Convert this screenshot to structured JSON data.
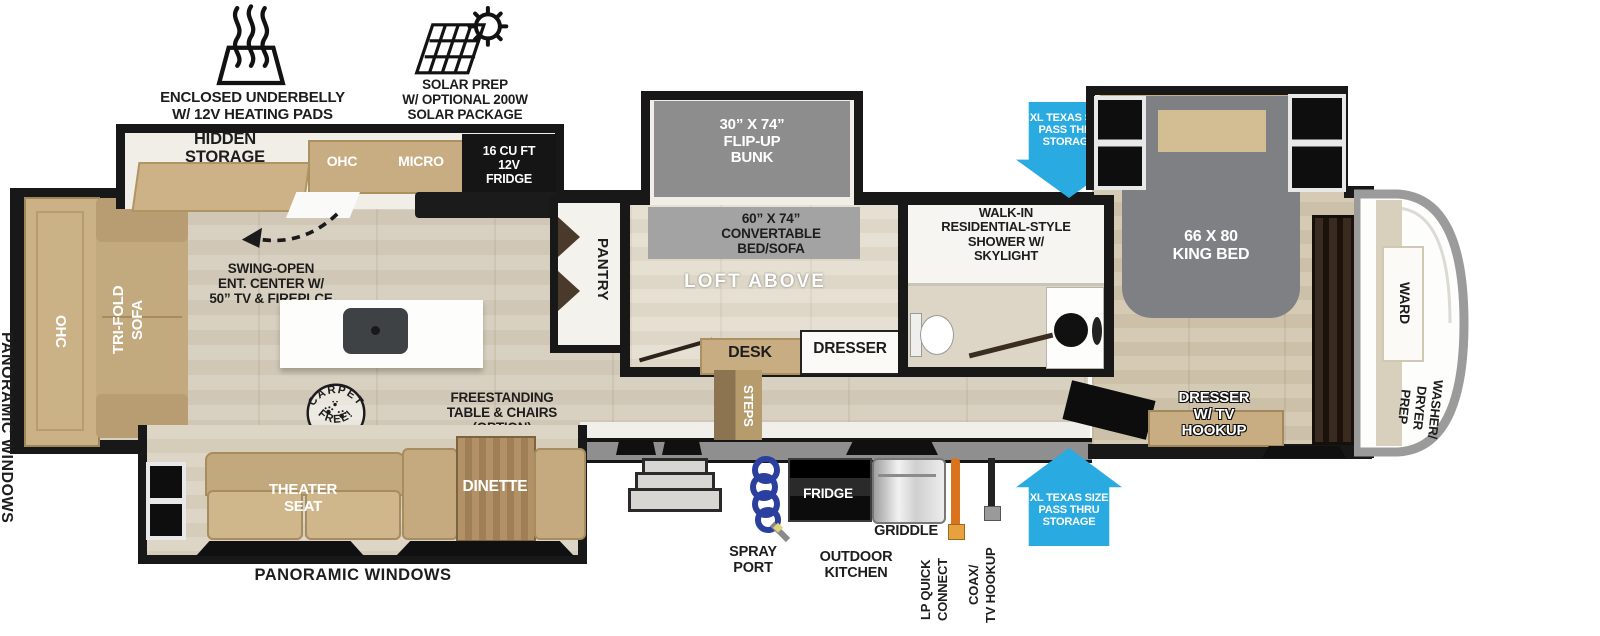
{
  "colors": {
    "accent_blue": "#29ABE2",
    "wall_black": "#181818",
    "cabinet_tan": "#c9ad82",
    "mattress_gray": "#8d8d8d",
    "hose_orange": "#d9731e",
    "coil_blue": "#2a3f9e"
  },
  "labels": {
    "underbelly": "ENCLOSED UNDERBELLY\nW/ 12V HEATING PADS",
    "solar": "SOLAR PREP\nW/ OPTIONAL 200W\nSOLAR PACKAGE",
    "hidden_storage": "HIDDEN\nSTORAGE",
    "ohc_kitchen": "OHC",
    "micro": "MICRO",
    "fridge_12v": "16 CU FT\n12V\nFRIDGE",
    "pantry": "PANTRY",
    "flip_up_bunk": "30” X 74”\nFLIP-UP\nBUNK",
    "convertable_bed_sofa": "60” X 74”\nCONVERTABLE\nBED/SOFA",
    "loft_above": "LOFT ABOVE",
    "desk": "DESK",
    "dresser": "DRESSER",
    "shower": "WALK-IN\nRESIDENTIAL-STYLE\nSHOWER W/\nSKYLIGHT",
    "pass_thru_top": "XL TEXAS SIZE\nPASS THRU\nSTORAGE",
    "pass_thru_bottom": "XL TEXAS SIZE\nPASS THRU\nSTORAGE",
    "king_bed": "66 X 80\nKING BED",
    "ward": "WARD",
    "washer_dryer_prep": "WASHER/\nDRYER\nPREP",
    "dresser_tv_hookup": "DRESSER\nW/ TV\nHOOKUP",
    "ohc_rear": "OHC",
    "tri_fold_sofa": "TRI-FOLD\nSOFA",
    "swing_open_ent": "SWING-OPEN\nENT. CENTER W/\n50” TV & FIREPLCE",
    "carpet_free_arc_top": "CARPET",
    "carpet_free_arc_bottom": "FREE!",
    "freestanding_table": "FREESTANDING\nTABLE & CHAIRS\n(OPTION)",
    "theater_seat": "THEATER\nSEAT",
    "dinette": "DINETTE",
    "steps": "STEPS",
    "panoramic_left": "PANORAMIC WINDOWS",
    "panoramic_bottom": "PANORAMIC WINDOWS",
    "spray_port": "SPRAY\nPORT",
    "outdoor_kitchen": "OUTDOOR\nKITCHEN",
    "fridge_outdoor": "FRIDGE",
    "griddle": "GRIDDLE",
    "lp_quick_connect": "LP QUICK\nCONNECT",
    "coax_tv_hookup": "COAX/\nTV HOOKUP"
  }
}
